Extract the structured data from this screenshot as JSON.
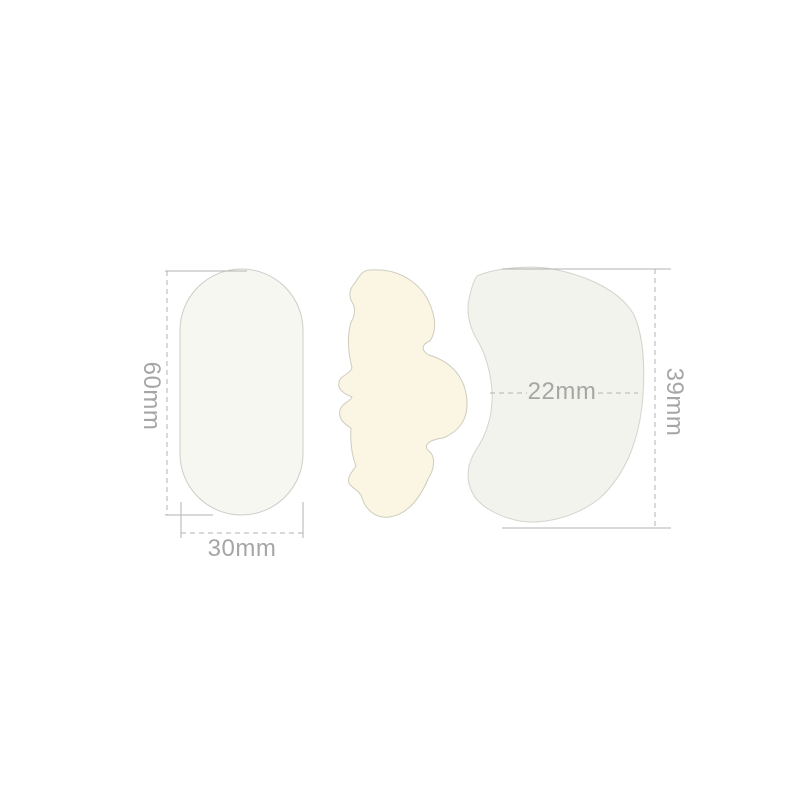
{
  "diagram": {
    "shapes": {
      "pill": {
        "name": "rounded-rectangle-patch",
        "fill": "#f7f7f1",
        "stroke": "#cdcdc8"
      },
      "contour": {
        "name": "contour-patch",
        "fill": "#faf6e3",
        "stroke": "#cfccbe"
      },
      "crescent": {
        "name": "crescent-patch",
        "fill": "#f2f3ed",
        "stroke": "#d3d5cd"
      }
    },
    "dimensions": {
      "pill_height": {
        "label": "60mm"
      },
      "pill_width": {
        "label": "30mm"
      },
      "crescent_width": {
        "label": "22mm"
      },
      "crescent_height": {
        "label": "39mm"
      }
    },
    "line_color": "#b3b3b3",
    "label_color": "#a6a6a6"
  }
}
